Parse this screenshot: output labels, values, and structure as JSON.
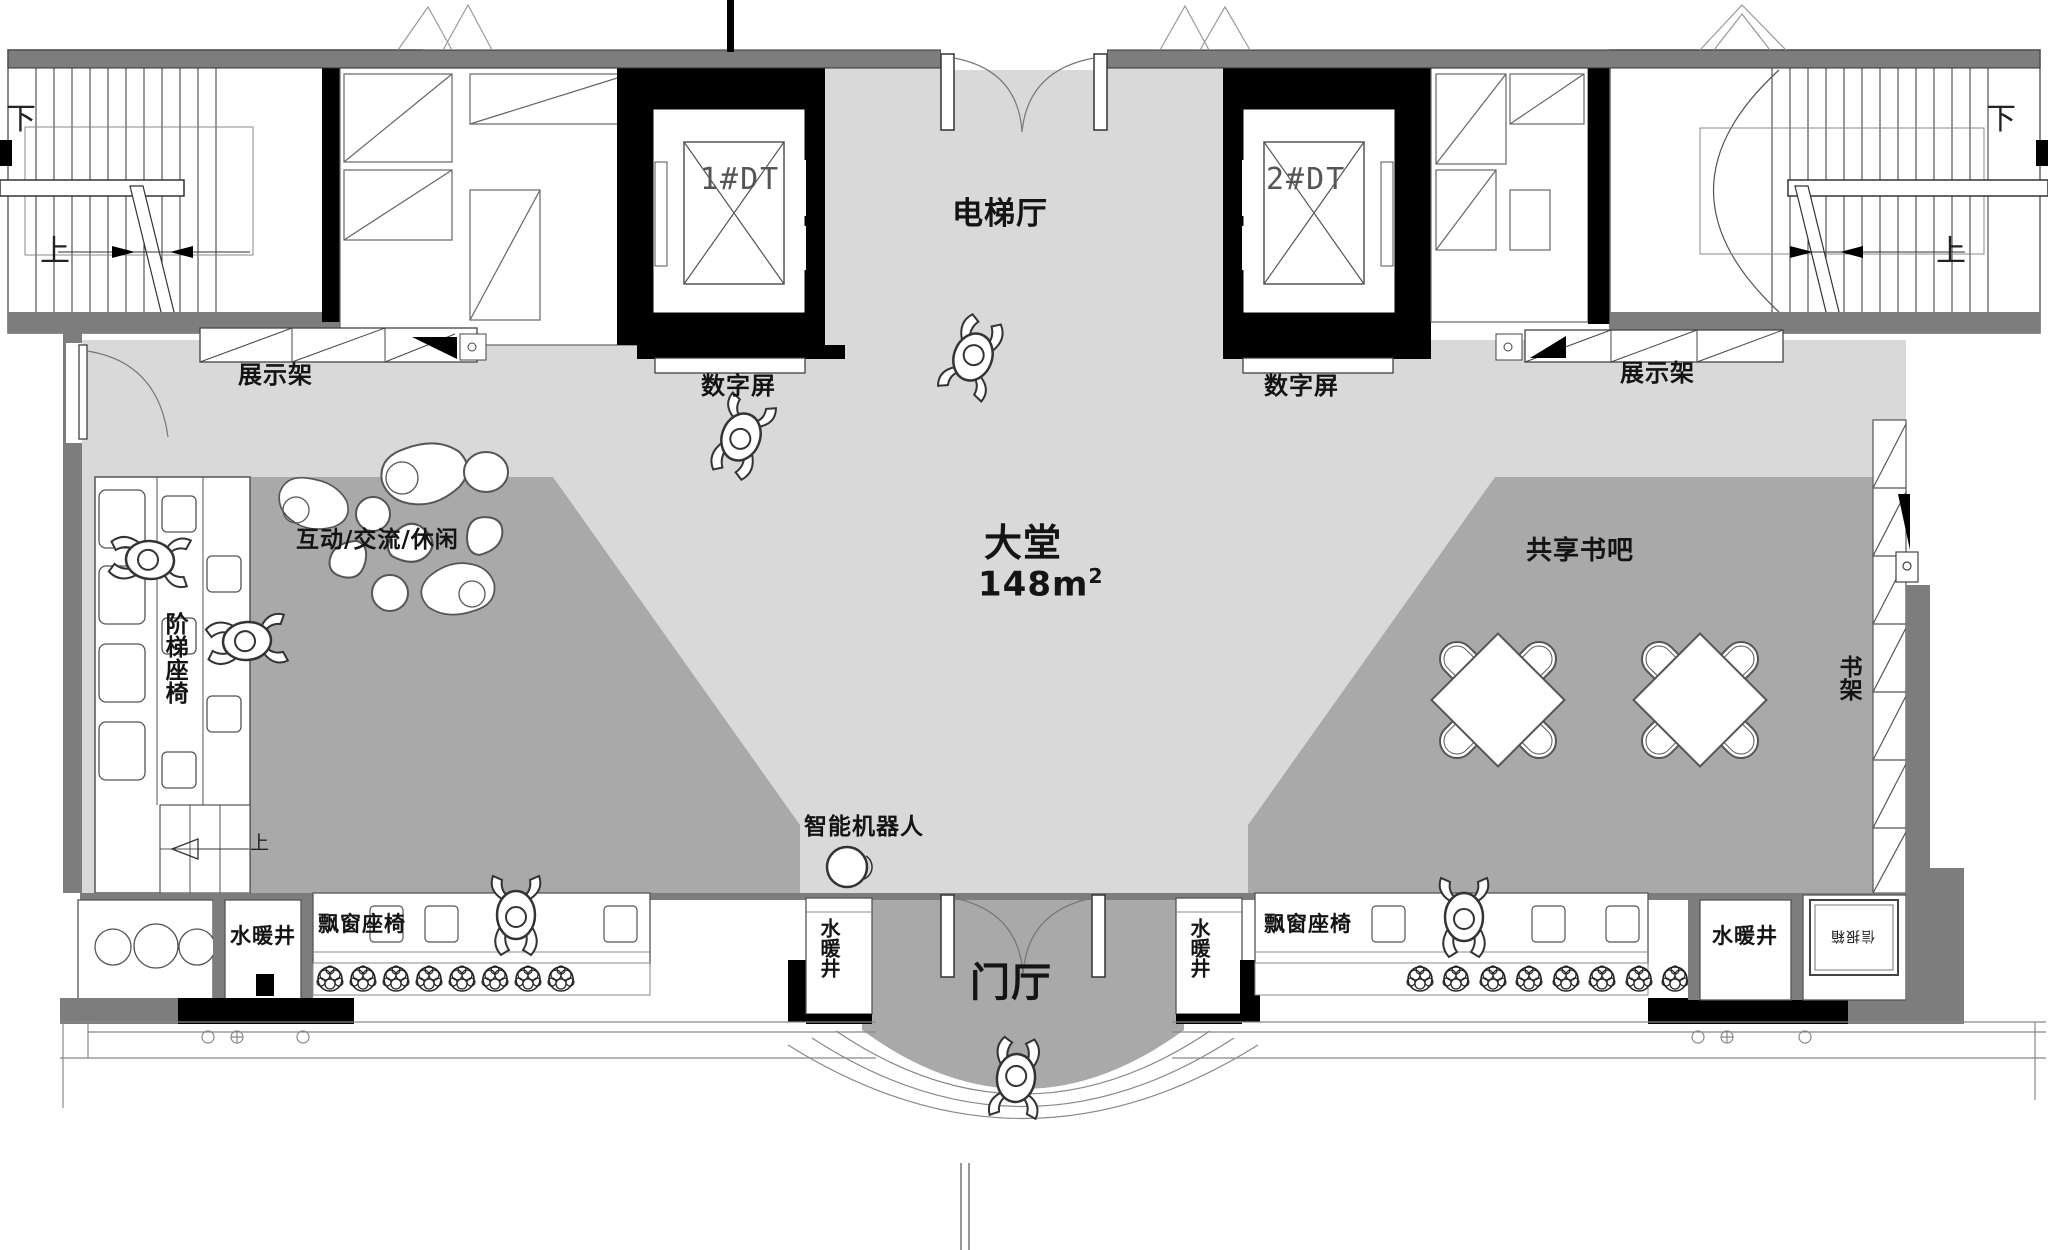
{
  "palette": {
    "floor_light": "#d9d9d9",
    "zone_gray": "#a9a9a9",
    "wall_gray": "#7d7d7d",
    "structure_black": "#000000",
    "line_ink": "#333333"
  },
  "plan": {
    "hall": {
      "elevator_hall": "电梯厅",
      "lobby": "大堂",
      "lobby_area": "148m",
      "lobby_area_exp": "2",
      "entrance": "门厅"
    },
    "elevators": {
      "e1": "1#DT",
      "e2": "2#DT"
    },
    "zones": {
      "interactive": "互动/交流/休闲",
      "book_bar": "共享书吧"
    },
    "fixtures": {
      "display_rack": "展示架",
      "digital_screen": "数字屏",
      "stepped_seating": "阶梯座椅",
      "bookshelf": "书架",
      "robot": "智能机器人",
      "utility_shaft": "水暖井",
      "bay_window_seat": "飘窗座椅",
      "mailbox": "信报箱"
    },
    "stairs": {
      "up": "上",
      "down": "下"
    }
  }
}
